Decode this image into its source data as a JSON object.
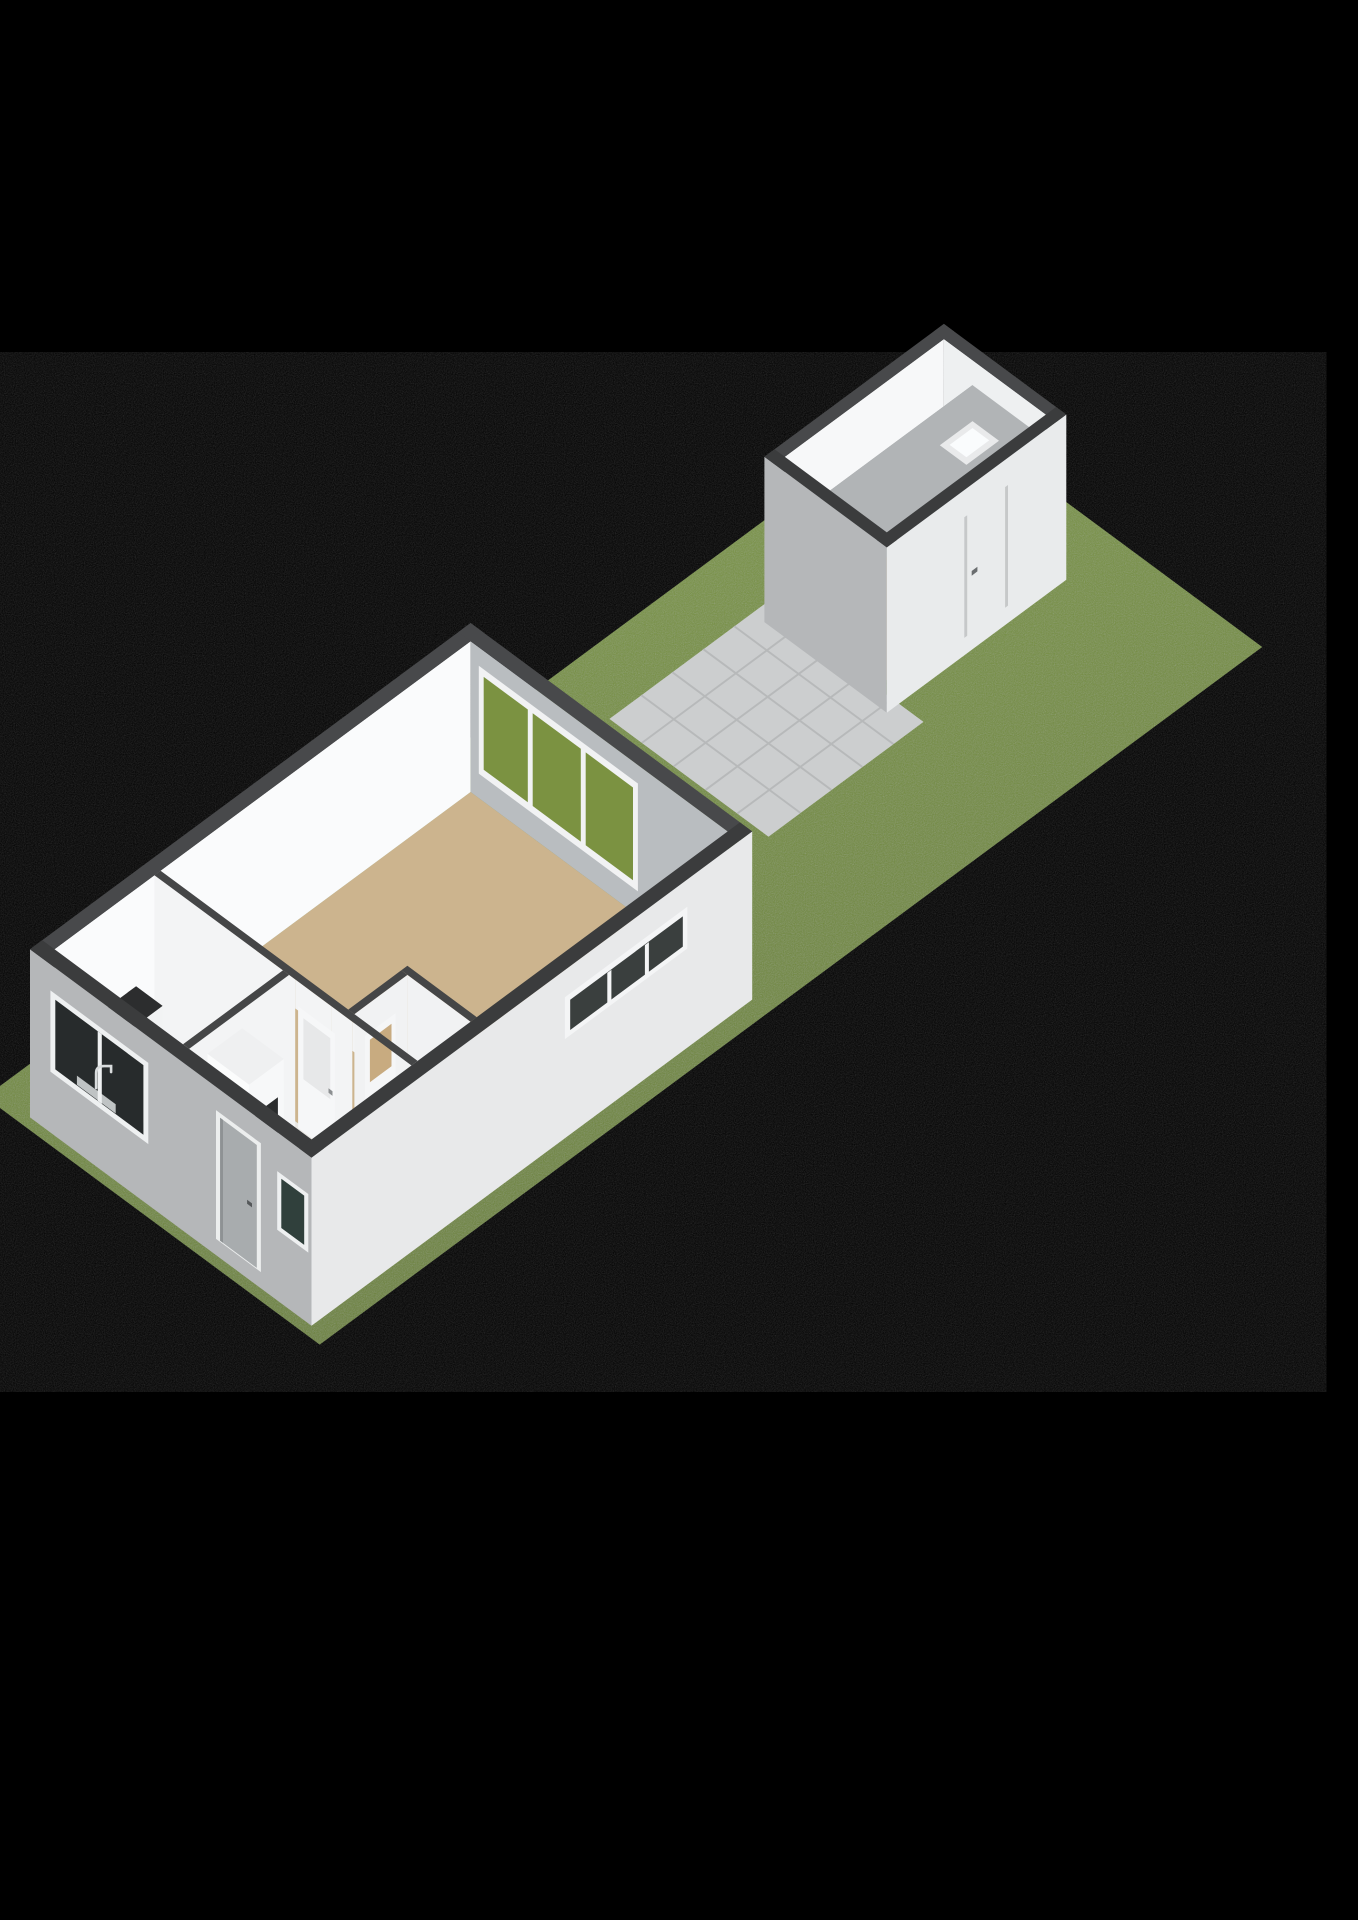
{
  "scene": {
    "kind": "3d-floorplan-render",
    "label": "isometric ground-floor plan with garden, terrace and detached garage",
    "background": "#000000"
  },
  "palette": {
    "grass_light": "#7e9a43",
    "grass_dark": "#6a8136",
    "terrace_tile": "#cccecf",
    "terrace_joint": "#b7b9ba",
    "wall_cap_near": "#3b3c3d",
    "wall_cap_far": "#48494b",
    "wall_interior_bright": "#fafbfc",
    "wall_interior_shaded": "#b9bdc0",
    "wall_exterior_sw": "#b5b7b9",
    "wall_exterior_se": "#e8e9ea",
    "floor_living": "#ccb48e",
    "floor_kitchen": "#c6cfd7",
    "floor_hall": "#e9e7e3",
    "floor_garage": "#c3a886",
    "garage_loft_slab": "#b1b4b6",
    "counter_top": "#2c2d2e",
    "hob_black": "#161717",
    "glass_dark": "#272b2c",
    "door_glass_tan": "#c8ab80",
    "frame_white": "#eef0f1"
  },
  "projection": {
    "ox": 30,
    "oy": 1100,
    "A": 40.8,
    "B": 30.2,
    "C": 58
  },
  "primitives": [
    {
      "n": "grass-parcel",
      "t": "pg",
      "p": [
        [
          -0.5,
          -0.6
        ],
        [
          22.6,
          -0.6
        ],
        [
          22.6,
          7.6
        ],
        [
          -0.5,
          7.6
        ]
      ],
      "f": "@grassGrad",
      "grain": true
    },
    {
      "n": "terrace-tiles",
      "t": "qh",
      "q": [
        13.4,
        0.8,
        17.2,
        4.7
      ],
      "z": 0.01,
      "f": "#cccecf"
    },
    {
      "n": "terrace-joint-lines-u",
      "t": "gr",
      "dir": "u",
      "u": [
        13.4,
        17.2
      ],
      "v": [
        0.8,
        4.7
      ],
      "step": 0.78,
      "w": 0.04,
      "z": 0.015,
      "f": "#b7b9ba"
    },
    {
      "n": "terrace-joint-lines-v",
      "t": "gr",
      "dir": "v",
      "u": [
        13.4,
        17.2
      ],
      "v": [
        0.8,
        4.7
      ],
      "step": 0.76,
      "w": 0.04,
      "z": 0.015,
      "f": "#b7b9ba"
    },
    {
      "n": "garage-floor",
      "t": "qh",
      "q": [
        17.45,
        1.05,
        21.35,
        3.55
      ],
      "z": 0,
      "f": "#c3a886"
    },
    {
      "n": "garage-wall-nw-interior",
      "t": "fu",
      "u": [
        17.45,
        21.35
      ],
      "v": 1.05,
      "h": [
        0,
        2.55
      ],
      "f": "#f7f8f9"
    },
    {
      "n": "garage-wall-ne-interior",
      "t": "fv",
      "v": [
        1.05,
        3.55
      ],
      "u": 21.35,
      "h": [
        0,
        2.55
      ],
      "f": "#eef0f1"
    },
    {
      "n": "garage-loft-slab-edge",
      "t": "fu",
      "u": [
        17.45,
        21.35
      ],
      "v": 1.75,
      "h": [
        2.0,
        2.12
      ],
      "f": "#8e9193"
    },
    {
      "n": "garage-loft-slab",
      "t": "qh",
      "q": [
        17.45,
        1.75,
        21.35,
        3.55
      ],
      "z": 2.12,
      "f": "#b1b4b6"
    },
    {
      "n": "garage-skylight-frame",
      "t": "qh",
      "q": [
        19.95,
        2.35,
        20.75,
        3.0
      ],
      "z": 2.125,
      "f": "#e9eaeb"
    },
    {
      "n": "garage-skylight-glass",
      "t": "qh",
      "q": [
        20.07,
        2.47,
        20.63,
        2.88
      ],
      "z": 2.13,
      "f": "#fafcfd"
    },
    {
      "n": "garage-wall-sw-exterior",
      "t": "fv",
      "v": [
        0.8,
        3.8
      ],
      "u": 17.2,
      "h": [
        -0.3,
        2.55
      ],
      "f": "#b5b7b9"
    },
    {
      "n": "garage-wall-se-exterior",
      "t": "fu",
      "u": [
        17.2,
        21.6
      ],
      "v": 3.8,
      "h": [
        -0.3,
        2.55
      ],
      "f": "#e9ebec"
    },
    {
      "n": "garage-door-seam-left",
      "t": "fu",
      "u": [
        19.1,
        19.17
      ],
      "v": 3.8,
      "h": [
        0,
        2.08
      ],
      "f": "#c6c8c9"
    },
    {
      "n": "garage-door-seam-right",
      "t": "fu",
      "u": [
        20.1,
        20.17
      ],
      "v": 3.8,
      "h": [
        0,
        2.08
      ],
      "f": "#c6c8c9"
    },
    {
      "n": "garage-door-handle",
      "t": "fu",
      "u": [
        19.28,
        19.42
      ],
      "v": 3.8,
      "h": [
        0.98,
        1.06
      ],
      "f": "#6a6d6f"
    },
    {
      "n": "garage-cap-nw",
      "t": "qh",
      "q": [
        17.2,
        0.8,
        21.6,
        1.05
      ],
      "z": 2.55,
      "f": "#48494b"
    },
    {
      "n": "garage-cap-ne",
      "t": "qh",
      "q": [
        21.35,
        0.8,
        21.6,
        3.8
      ],
      "z": 2.55,
      "f": "#48494b"
    },
    {
      "n": "garage-cap-sw",
      "t": "qh",
      "q": [
        17.2,
        0.8,
        17.45,
        3.8
      ],
      "z": 2.55,
      "f": "#3b3c3d"
    },
    {
      "n": "garage-cap-se",
      "t": "qh",
      "q": [
        17.2,
        3.55,
        21.6,
        3.8
      ],
      "z": 2.55,
      "f": "#3b3c3d"
    },
    {
      "n": "living-room-floor",
      "t": "qh",
      "q": [
        2.9,
        0.3,
        10.5,
        6.6
      ],
      "z": 0,
      "f": "#ccb48e"
    },
    {
      "n": "kitchen-floor",
      "t": "qh",
      "q": [
        0.3,
        0.3,
        2.9,
        3.6
      ],
      "z": 0,
      "f": "#c6cfd7"
    },
    {
      "n": "hallway-floor",
      "t": "qh",
      "q": [
        0.3,
        3.6,
        2.9,
        6.6
      ],
      "z": 0,
      "f": "#e9e7e3"
    },
    {
      "n": "toilet-floor",
      "t": "qh",
      "q": [
        2.9,
        5.05,
        4.2,
        6.6
      ],
      "z": 0,
      "f": "#eae8e5"
    },
    {
      "n": "house-wall-nw-interior",
      "t": "fu",
      "u": [
        0.3,
        10.5
      ],
      "v": 0.3,
      "h": [
        0,
        2.6
      ],
      "f": "#fafbfc"
    },
    {
      "n": "house-wall-ne-interior",
      "t": "fv",
      "v": [
        0.3,
        6.6
      ],
      "u": 10.5,
      "h": [
        0,
        2.6
      ],
      "f": "#b9bdc0"
    },
    {
      "n": "ne-window-frame",
      "t": "fv",
      "v": [
        0.5,
        4.4
      ],
      "u": 10.5,
      "h": [
        0.42,
        2.28
      ],
      "f": "#f1f2f3"
    },
    {
      "n": "ne-window-pane-1",
      "t": "fv",
      "v": [
        0.62,
        1.7
      ],
      "u": 10.5,
      "h": [
        0.55,
        2.15
      ],
      "f": "#7b9241"
    },
    {
      "n": "ne-window-pane-2",
      "t": "fv",
      "v": [
        1.82,
        3.0
      ],
      "u": 10.5,
      "h": [
        0.55,
        2.15
      ],
      "f": "#7b9241"
    },
    {
      "n": "ne-window-pane-3",
      "t": "fv",
      "v": [
        3.12,
        4.28
      ],
      "u": 10.5,
      "h": [
        0.55,
        2.15
      ],
      "f": "#7b9241"
    },
    {
      "n": "partition-living-face-a",
      "t": "fv",
      "v": [
        0.3,
        3.75
      ],
      "u": 2.75,
      "h": [
        0,
        2.6
      ],
      "f": "#f3f4f5"
    },
    {
      "n": "partition-living-face-b",
      "t": "fv",
      "v": [
        4.65,
        5.15
      ],
      "u": 2.75,
      "h": [
        0,
        2.6
      ],
      "f": "#f3f4f5"
    },
    {
      "n": "partition-living-face-c",
      "t": "fv",
      "v": [
        5.95,
        6.6
      ],
      "u": 2.75,
      "h": [
        0,
        2.6
      ],
      "f": "#f3f4f5"
    },
    {
      "n": "partition-living-lintel-1",
      "t": "fv",
      "v": [
        3.75,
        4.65
      ],
      "u": 2.75,
      "h": [
        2.1,
        2.6
      ],
      "f": "#f3f4f5"
    },
    {
      "n": "partition-living-lintel-2",
      "t": "fv",
      "v": [
        5.15,
        5.95
      ],
      "u": 2.75,
      "h": [
        2.1,
        2.6
      ],
      "f": "#f3f4f5"
    },
    {
      "n": "door-hall-living-leaf",
      "t": "fv",
      "v": [
        3.75,
        4.65
      ],
      "u": 2.82,
      "h": [
        0,
        2.1
      ],
      "f": "#f6f7f8"
    },
    {
      "n": "door-hall-living-panel",
      "t": "fv",
      "v": [
        3.87,
        4.53
      ],
      "u": 2.83,
      "h": [
        0.9,
        1.95
      ],
      "f": "#e7e8e9"
    },
    {
      "n": "door-hall-living-handle",
      "t": "fv",
      "v": [
        4.48,
        4.58
      ],
      "u": 2.835,
      "h": [
        0.98,
        1.06
      ],
      "f": "#8d9092"
    },
    {
      "n": "door-hall-toilet-leaf",
      "t": "fv",
      "v": [
        5.15,
        5.95
      ],
      "u": 2.82,
      "h": [
        0,
        2.1
      ],
      "f": "#f6f7f8"
    },
    {
      "n": "door-hall-toilet-glass",
      "t": "fv",
      "v": [
        5.27,
        5.83
      ],
      "u": 2.83,
      "h": [
        1.25,
        1.98
      ],
      "f": "#c8ab80"
    },
    {
      "n": "door-hall-toilet-handle",
      "t": "fv",
      "v": [
        5.2,
        5.3
      ],
      "u": 2.835,
      "h": [
        0.98,
        1.06
      ],
      "f": "#8d9092"
    },
    {
      "n": "partition-kitchen-hall-face",
      "t": "fu",
      "u": [
        0.3,
        2.75
      ],
      "v": 3.6,
      "h": [
        0,
        2.6
      ],
      "f": "#f3f4f5"
    },
    {
      "n": "toilet-wall-nw-face",
      "t": "fu",
      "u": [
        2.9,
        4.2
      ],
      "v": 5.05,
      "h": [
        0,
        2.6
      ],
      "f": "#f1f2f3"
    },
    {
      "n": "door-toilet-leaf",
      "t": "fu",
      "u": [
        3.15,
        3.9
      ],
      "v": 5.06,
      "h": [
        0,
        2.1
      ],
      "f": "#f5f6f7"
    },
    {
      "n": "door-toilet-glass",
      "t": "fu",
      "u": [
        3.26,
        3.79
      ],
      "v": 5.07,
      "h": [
        1.25,
        1.98
      ],
      "f": "#c8ab80"
    },
    {
      "n": "toilet-wall-east-face",
      "t": "fv",
      "v": [
        5.05,
        6.6
      ],
      "u": 4.2,
      "h": [
        0,
        2.6
      ],
      "f": "#f1f2f3"
    },
    {
      "n": "kitchen-counter-nw-front",
      "t": "fu",
      "u": [
        0.3,
        2.3
      ],
      "v": 0.95,
      "h": [
        0,
        0.92
      ],
      "f": "#f2f3f4"
    },
    {
      "n": "kitchen-counter-nw-top",
      "t": "qh",
      "q": [
        0.3,
        0.3,
        2.3,
        0.95
      ],
      "z": 0.92,
      "f": "#2c2d2e"
    },
    {
      "n": "kitchen-hob",
      "t": "qh",
      "q": [
        0.7,
        0.36,
        1.9,
        0.9
      ],
      "z": 0.925,
      "f": "#161717"
    },
    {
      "n": "hob-burner-1",
      "t": "bn",
      "at": [
        1.0,
        0.52,
        0.93
      ]
    },
    {
      "n": "hob-burner-2",
      "t": "bn",
      "at": [
        1.0,
        0.74,
        0.93
      ]
    },
    {
      "n": "hob-burner-3",
      "t": "bn",
      "at": [
        1.6,
        0.52,
        0.93
      ]
    },
    {
      "n": "hob-burner-4",
      "t": "bn",
      "at": [
        1.6,
        0.74,
        0.93
      ]
    },
    {
      "n": "kitchen-counter-sw-end",
      "t": "fu",
      "u": [
        0.3,
        0.95
      ],
      "v": 3.45,
      "h": [
        0,
        0.92
      ],
      "f": "#f2f3f4"
    },
    {
      "n": "kitchen-counter-sw-top",
      "t": "qh",
      "q": [
        0.3,
        0.95,
        0.95,
        3.45
      ],
      "z": 0.92,
      "f": "#2c2d2e"
    },
    {
      "n": "kitchen-sink-rim",
      "t": "qh",
      "q": [
        0.42,
        1.3,
        0.85,
        2.25
      ],
      "z": 0.925,
      "f": "#aeb2b3"
    },
    {
      "n": "kitchen-sink-basin",
      "t": "qh",
      "q": [
        0.47,
        1.38,
        0.8,
        2.17
      ],
      "z": 0.93,
      "f": "#6a6e70"
    },
    {
      "n": "hall-closet-front",
      "t": "fu",
      "u": [
        0.75,
        1.6
      ],
      "v": 4.62,
      "h": [
        0,
        2.28
      ],
      "f": "#f7f8f9"
    },
    {
      "n": "hall-closet-side",
      "t": "fv",
      "v": [
        3.6,
        4.62
      ],
      "u": 0.75,
      "h": [
        0,
        2.28
      ],
      "f": "#fbfcfc"
    },
    {
      "n": "hall-closet-top",
      "t": "qh",
      "q": [
        0.75,
        3.6,
        1.6,
        4.62
      ],
      "z": 2.28,
      "f": "#eff0f1"
    },
    {
      "n": "hall-closet-appliance-panel",
      "t": "fu",
      "u": [
        0.9,
        1.45
      ],
      "v": 4.625,
      "h": [
        0.75,
        1.7
      ],
      "f": "#2a2c2d"
    },
    {
      "n": "house-wall-se-exterior",
      "t": "fu",
      "u": [
        0,
        10.8
      ],
      "v": 6.9,
      "h": [
        -0.3,
        2.6
      ],
      "f": "#e8e9ea"
    },
    {
      "n": "se-band-window-frame",
      "t": "fu",
      "u": [
        6.2,
        9.2
      ],
      "v": 6.91,
      "h": [
        1.42,
        2.14
      ],
      "f": "#f4f5f6"
    },
    {
      "n": "se-band-window-glass",
      "t": "fu",
      "u": [
        6.32,
        9.08
      ],
      "v": 6.92,
      "h": [
        1.52,
        2.04
      ],
      "f": "#3a3f3e"
    },
    {
      "n": "se-band-window-mullion-1",
      "t": "fu",
      "u": [
        7.22,
        7.32
      ],
      "v": 6.93,
      "h": [
        1.52,
        2.04
      ],
      "f": "#f4f5f6"
    },
    {
      "n": "se-band-window-mullion-2",
      "t": "fu",
      "u": [
        8.14,
        8.24
      ],
      "v": 6.93,
      "h": [
        1.52,
        2.04
      ],
      "f": "#f4f5f6"
    },
    {
      "n": "house-wall-sw-exterior",
      "t": "fv",
      "v": [
        0,
        6.9
      ],
      "u": 0,
      "h": [
        -0.3,
        2.6
      ],
      "f": "#b5b7b9"
    },
    {
      "n": "kitchen-window-frame",
      "t": "fv",
      "v": [
        0.5,
        2.9
      ],
      "u": 0,
      "h": [
        0.75,
        2.15
      ],
      "f": "#eef0f1"
    },
    {
      "n": "kitchen-window-glass",
      "t": "fv",
      "v": [
        0.62,
        2.78
      ],
      "u": 0,
      "h": [
        0.85,
        2.05
      ],
      "f": "#272b2c"
    },
    {
      "n": "kitchen-window-sill-hint",
      "t": "fv",
      "v": [
        1.15,
        2.1
      ],
      "u": 0,
      "h": [
        0.86,
        1.02
      ],
      "f": "#bfc3c4"
    },
    {
      "n": "kitchen-window-mullion",
      "t": "fv",
      "v": [
        1.66,
        1.76
      ],
      "u": 0,
      "h": [
        0.85,
        2.05
      ],
      "f": "#eef0f1"
    },
    {
      "n": "kitchen-faucet",
      "t": "fc",
      "at": [
        0,
        1.62,
        1.05
      ]
    },
    {
      "n": "front-door-frame",
      "t": "fv",
      "v": [
        4.56,
        5.66
      ],
      "u": 0,
      "h": [
        -0.02,
        2.2
      ],
      "f": "#eceeee"
    },
    {
      "n": "front-door-leaf",
      "t": "fv",
      "v": [
        4.66,
        5.56
      ],
      "u": 0,
      "h": [
        0,
        2.12
      ],
      "f": "#a8acae"
    },
    {
      "n": "front-door-edge-shadow",
      "t": "fv",
      "v": [
        4.66,
        4.73
      ],
      "u": 0,
      "h": [
        0,
        2.12
      ],
      "f": "#8e9294"
    },
    {
      "n": "front-door-handle",
      "t": "fv",
      "v": [
        5.32,
        5.44
      ],
      "u": 0,
      "h": [
        0.98,
        1.05
      ],
      "f": "#55585a"
    },
    {
      "n": "sw-small-window-frame",
      "t": "fv",
      "v": [
        6.06,
        6.82
      ],
      "u": 0,
      "h": [
        0.92,
        1.93
      ],
      "f": "#eef0f1"
    },
    {
      "n": "sw-small-window-glass",
      "t": "fv",
      "v": [
        6.16,
        6.72
      ],
      "u": 0,
      "h": [
        1.0,
        1.85
      ],
      "f": "#30403c"
    },
    {
      "n": "house-cap-nw",
      "t": "qh",
      "q": [
        0,
        0,
        10.8,
        0.3
      ],
      "z": 2.6,
      "f": "#48494b"
    },
    {
      "n": "house-cap-ne",
      "t": "qh",
      "q": [
        10.5,
        0,
        10.8,
        6.9
      ],
      "z": 2.6,
      "f": "#48494b"
    },
    {
      "n": "house-cap-sw",
      "t": "qh",
      "q": [
        0,
        0,
        0.3,
        6.9
      ],
      "z": 2.6,
      "f": "#3b3c3d"
    },
    {
      "n": "house-cap-se",
      "t": "qh",
      "q": [
        0,
        6.6,
        10.8,
        6.9
      ],
      "z": 2.6,
      "f": "#3b3c3d"
    },
    {
      "n": "cap-partition-living",
      "t": "qh",
      "q": [
        2.75,
        0.3,
        2.9,
        6.6
      ],
      "z": 2.6,
      "f": "#454647"
    },
    {
      "n": "cap-partition-kitchen-hall",
      "t": "qh",
      "q": [
        0.3,
        3.45,
        2.75,
        3.6
      ],
      "z": 2.6,
      "f": "#454647"
    },
    {
      "n": "cap-toilet-nw",
      "t": "qh",
      "q": [
        2.9,
        4.9,
        4.2,
        5.05
      ],
      "z": 2.6,
      "f": "#454647"
    },
    {
      "n": "cap-toilet-east",
      "t": "qh",
      "q": [
        4.2,
        4.9,
        4.35,
        6.6
      ],
      "z": 2.6,
      "f": "#454647"
    }
  ]
}
